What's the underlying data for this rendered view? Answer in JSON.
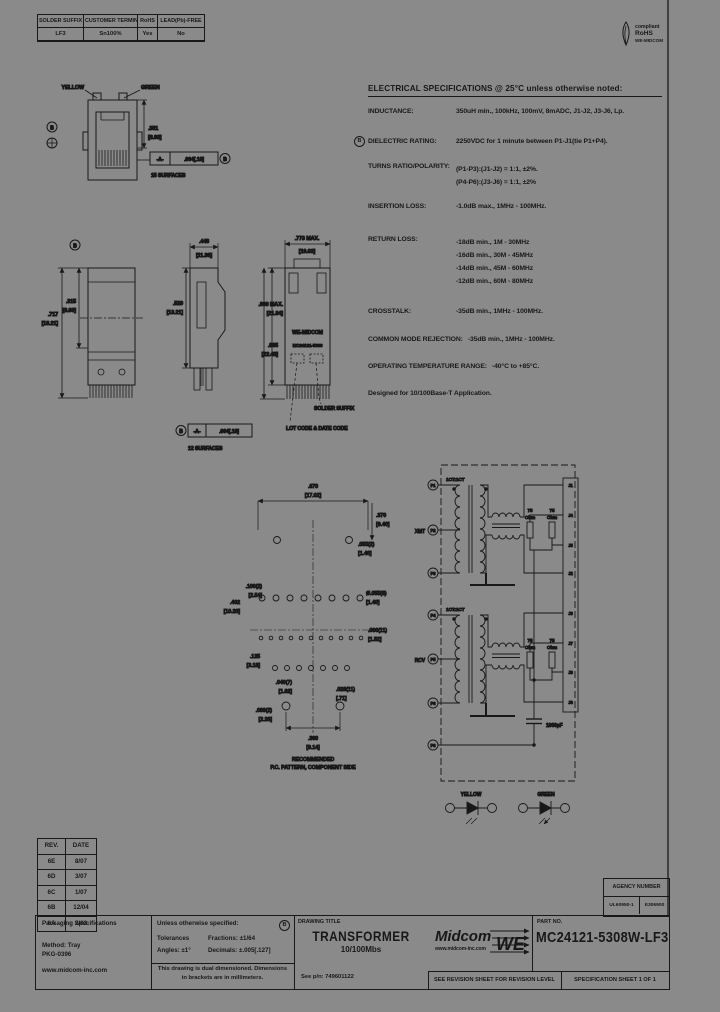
{
  "top_table": {
    "headers": [
      "SOLDER SUFFIX",
      "CUSTOMER TERMINAL",
      "RoHS",
      "LEAD(Pb)-FREE"
    ],
    "values": [
      "LF3",
      "Sn100%",
      "Yes",
      "No"
    ]
  },
  "rohs_badge": {
    "compliant": "compliant",
    "rohs": "RoHS",
    "brand": "WE-MIDCOM"
  },
  "electrical": {
    "title": "ELECTRICAL SPECIFICATIONS @ 25°C unless otherwise noted:",
    "inductance_label": "INDUCTANCE:",
    "inductance_value": "350uH min., 100kHz, 100mV, 8mADC, J1-J2, J3-J6, Lp.",
    "dielectric_balloon": "B",
    "dielectric_label": "DIELECTRIC RATING:",
    "dielectric_value": "2250VDC for 1 minute between P1-J1(tie P1+P4).",
    "turns_label": "TURNS RATIO/POLARITY:",
    "turns_value_1": "(P1-P3):(J1-J2) = 1:1, ±2%.",
    "turns_value_2": "(P4-P6):(J3-J6) = 1:1, ±2%",
    "insertion_label": "INSERTION LOSS:",
    "insertion_value": "-1.0dB max., 1MHz - 100MHz.",
    "return_label": "RETURN LOSS:",
    "return_value_1": "-18dB min., 1M - 30MHz",
    "return_value_2": "-16dB min., 30M - 45MHz",
    "return_value_3": "-14dB min., 45M - 60MHz",
    "return_value_4": "-12dB min., 60M - 80MHz",
    "crosstalk_label": "CROSSTALK:",
    "crosstalk_value": "-35dB min., 1MHz - 100MHz.",
    "cmr_label": "COMMON MODE REJECTION:",
    "cmr_value": "-35dB min., 1MHz - 100MHz.",
    "temp_label": "OPERATING TEMPERATURE RANGE:",
    "temp_value": "-40°C to +85°C.",
    "footnote": "Designed for 10/100Base-T Application."
  },
  "front_view": {
    "yellow_label": "YELLOW",
    "green_label": "GREEN",
    "dim_in": ".351",
    "dim_mm": "[8.93]",
    "balloon_b": "B",
    "datum_cell": "-A-",
    "tol_cell": ".004[.10]",
    "frame_balloon": "B",
    "surfaces_note": "15 SURFACES"
  },
  "views": {
    "balloon_b": "B",
    "h1_in": ".315",
    "h1_mm": "[8.00]",
    "h2_in": ".717",
    "h2_mm": "[18.21]",
    "w_in": ".448",
    "w_mm": "[11.38]",
    "h3_in": ".520",
    "h3_mm": "[13.21]",
    "d_in": ".773 MAX.",
    "d_mm": "[19.63]",
    "d2_in": ".860 MAX.",
    "d2_mm": "[21.84]",
    "d3_in": ".885",
    "d3_mm": "[22.48]",
    "marking_1": "WE-MIDCOM",
    "marking_2": "MC24121-5308",
    "callout_solder": "SOLDER SUFFIX",
    "callout_lot": "LOT CODE & DATE CODE",
    "frame_balloon": "B",
    "datum_cell": "-A-",
    "tol_cell": ".004[.10]",
    "surfaces_note": "12 SURFACES"
  },
  "pcb": {
    "d670_in": ".670",
    "d670_mm": "[17.02]",
    "d370_in": ".370",
    "d370_mm": "[9.40]",
    "d055a_in": ".055(2)",
    "d055a_mm": "[1.40]",
    "d100_in": ".100(2)",
    "d100_mm": "[2.54]",
    "d402_in": ".402",
    "d402_mm": "[10.20]",
    "d055b_in": "Ø.055(8)",
    "d055b_mm": "[1.40]",
    "d060_in": ".060(11)",
    "d060_mm": "[1.52]",
    "d125_in": ".125",
    "d125_mm": "[3.18]",
    "d040_in": ".040(7)",
    "d040_mm": "[1.02]",
    "d028_in": ".028(11)",
    "d028_mm": "[.71]",
    "d089_in": ".089(2)",
    "d089_mm": "[2.26]",
    "d360_in": ".360",
    "d360_mm": "[9.14]",
    "caption_1": "RECOMMENDED",
    "caption_2": "P.C. PATTERN, COMPONENT SIDE"
  },
  "schematic": {
    "xmt": "XMT",
    "rcv": "RCV",
    "ratio_top": "1CT:1CT",
    "ratio_bottom": "1CT:1CT",
    "res": "75",
    "res_unit": "Ohm",
    "cap_value": "1000pF",
    "p_pins": [
      "P1",
      "P2",
      "P3",
      "P4",
      "P5",
      "P6",
      "P8"
    ],
    "j_pins": [
      "J1",
      "J4",
      "J5",
      "J2",
      "J3",
      "J7",
      "J8",
      "J6"
    ],
    "yellow_label": "YELLOW",
    "green_label": "GREEN"
  },
  "revisions": {
    "rev_header": "REV.",
    "date_header": "DATE",
    "rows": [
      {
        "rev": "6E",
        "date": "8/07"
      },
      {
        "rev": "6D",
        "date": "3/07"
      },
      {
        "rev": "6C",
        "date": "1/07"
      },
      {
        "rev": "6B",
        "date": "12/04"
      },
      {
        "rev": "6A",
        "date": "2/03"
      }
    ]
  },
  "packaging": {
    "title": "Packaging Specifications",
    "method": "Method:  Tray",
    "pkg_number": "PKG-0396",
    "url": "www.midcom-inc.com"
  },
  "tolerances": {
    "heading": "Unless otherwise specified:",
    "balloon": "B",
    "row1_left": "Tolerances",
    "row1_right": "Fractions: ±1/64",
    "row2_left": "Angles: ±1°",
    "row2_right": "Decimals: ±.005[.127]",
    "dual_line1": "This drawing is dual dimensioned.  Dimensions",
    "dual_line2": "in brackets are in millimeters."
  },
  "titleblock": {
    "drawing_title_label": "DRAWING TITLE",
    "title": "TRANSFORMER",
    "subtitle": "10/100Mbs",
    "see_pn": "See p/n: 749601122",
    "brand": "Midcom",
    "brand_url": "www.midcom-inc.com",
    "brand_we": "WE",
    "part_label": "PART NO.",
    "part_number": "MC24121-5308W-LF3",
    "revision_note": "SEE REVISION SHEET FOR REVISION LEVEL",
    "sheet_note": "SPECIFICATION SHEET  1  OF  1",
    "agency_label": "AGENCY NUMBER",
    "agency_cell_1": "UL60950-1",
    "agency_cell_2": "E306900"
  }
}
